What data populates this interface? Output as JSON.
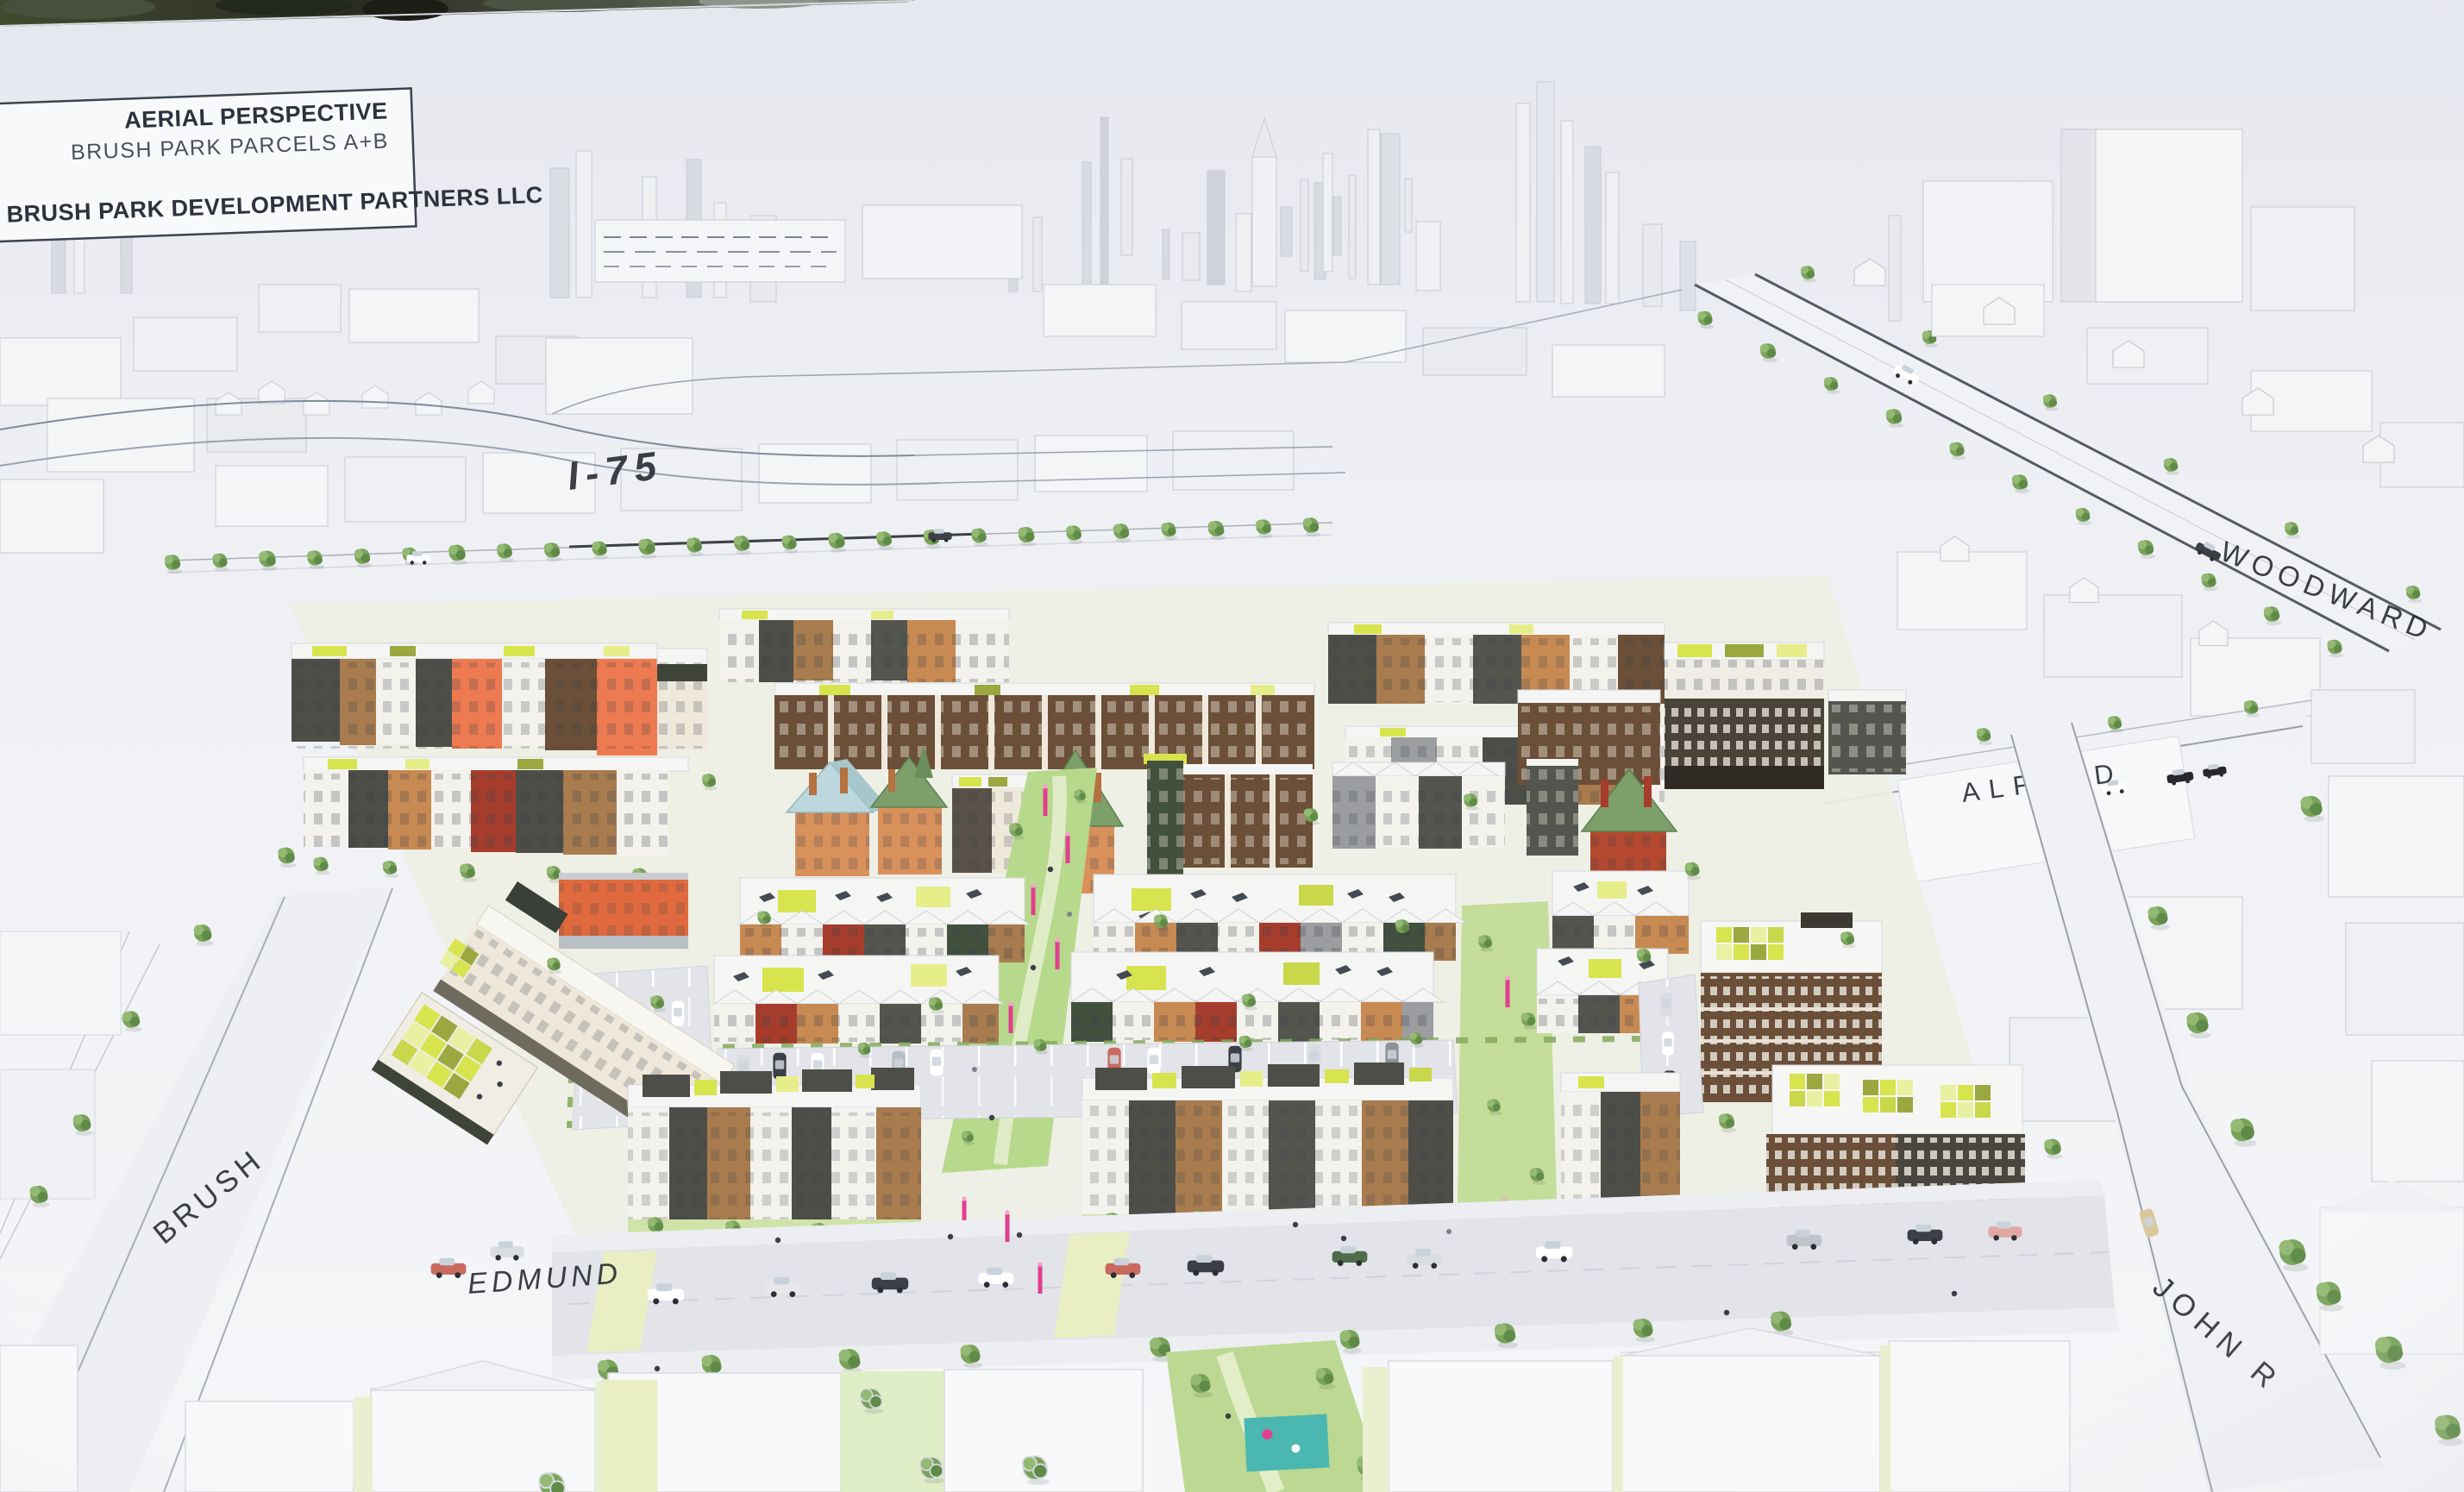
{
  "title_block": {
    "project_title": "AERIAL PERSPECTIVE",
    "project_subtitle": "BRUSH PARK PARCELS A+B",
    "developer": "BRUSH PARK DEVELOPMENT PARTNERS LLC"
  },
  "street_labels": {
    "i75": "I-75",
    "woodward": "WOODWARD",
    "alfred": "ALFRED",
    "brush": "BRUSH",
    "edmund": "EDMUND",
    "john_r": "JOHN R"
  },
  "palette": {
    "sky": "#e8eaf1",
    "board_white": "#f5f6f8",
    "massing_face": "#e3e5e9",
    "massing_side": "#d3d6db",
    "outline": "#c3c6cd",
    "label_ink": "#23262e",
    "tree_green": "#7aa35a",
    "lawn": "#cfe3a8",
    "paseo_green": "#b7d98c",
    "green_roof_chartreuse": "#d7e44d",
    "green_roof_olive": "#9aa83f",
    "facade_charcoal": "#4d4e48",
    "facade_brown": "#6b4f38",
    "facade_wood": "#a87c4e",
    "facade_tan": "#c78a52",
    "facade_orange": "#ed7a50",
    "facade_red": "#a63d2c",
    "facade_cream": "#efe8da",
    "facade_white": "#f3f2ed",
    "facade_darkgreen": "#42503e",
    "victorian_brick": "#d9915c",
    "victorian_blue_roof": "#bcd8de",
    "victorian_green_roof": "#7da06b",
    "banner_pink": "#e23f8f",
    "playground_teal": "#4ab7b0"
  }
}
